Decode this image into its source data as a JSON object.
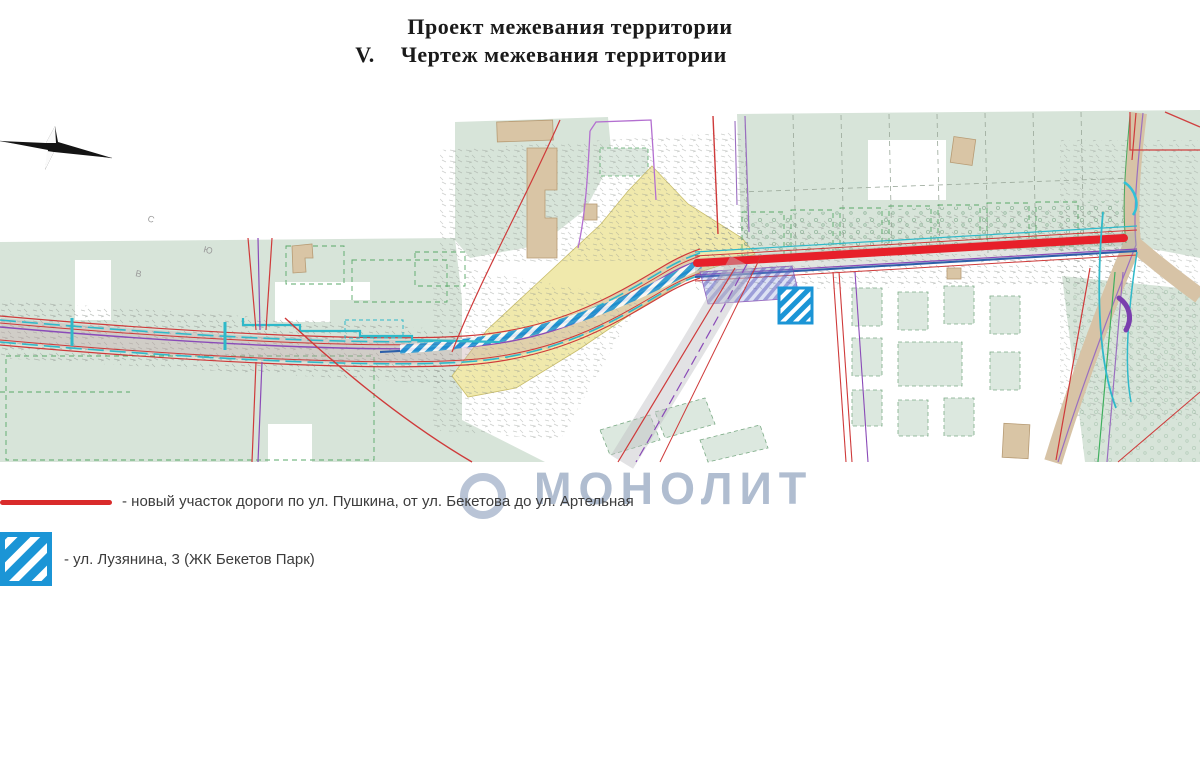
{
  "header": {
    "title": "Проект межевания территории",
    "section_number": "V.",
    "section_title": "Чертеж межевания территории"
  },
  "map": {
    "watermark": "МОНОЛИТ",
    "compass": {
      "north": "С",
      "south": "Ю",
      "east": "В"
    }
  },
  "legend": {
    "items": [
      {
        "symbol": "red-line",
        "color": "#d92b2b",
        "label": "- новый участок дороги по ул. Пушкина, от ул. Бекетова до ул. Артельная"
      },
      {
        "symbol": "blue-hatched-square",
        "color": "#1b95d6",
        "label": "- ул. Лузянина, 3 (ЖК Бекетов Парк)"
      }
    ]
  },
  "colors": {
    "new_road_red": "#e7202a",
    "boundary_red": "#cf3a3a",
    "parcel_marker_blue": "#1b95d6",
    "map_green": "#d7e4d9",
    "planning_area_yellow": "#f0e9ac",
    "utility_cyan": "#2fb9c9",
    "boundary_purple": "#8a4ab8",
    "watermark_blue_gray": "#7689ac"
  }
}
